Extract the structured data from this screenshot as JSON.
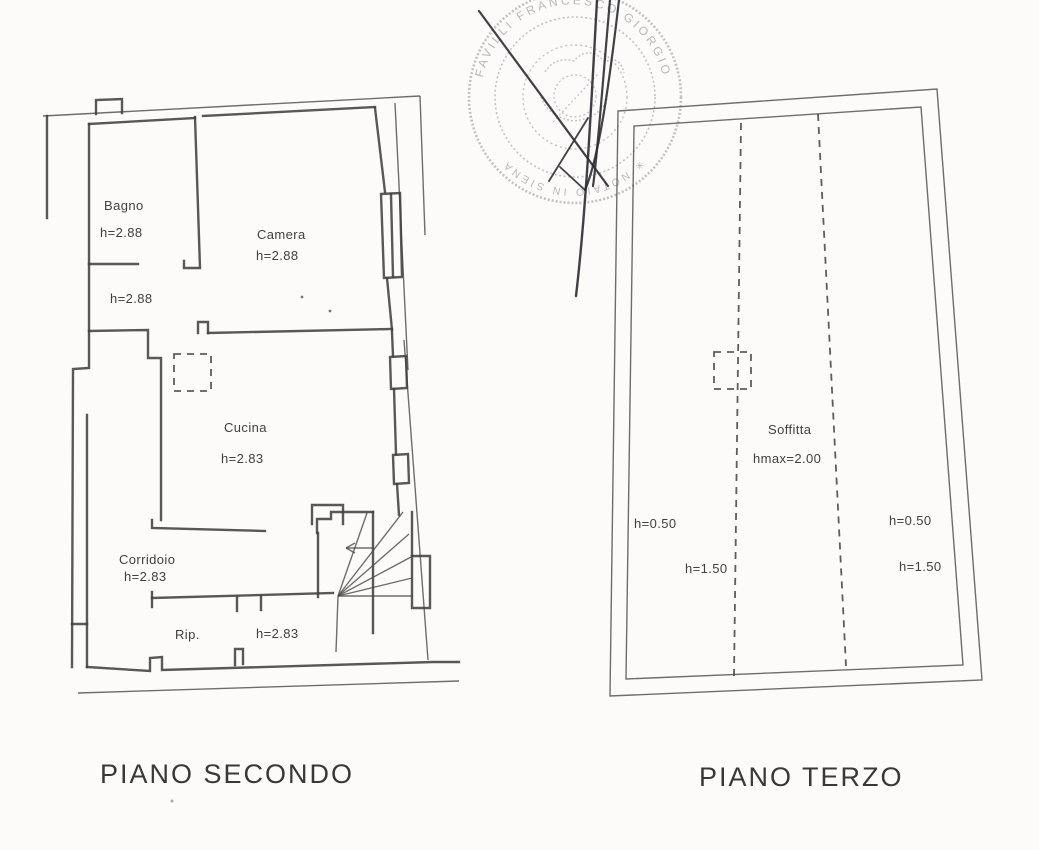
{
  "document": {
    "type_note": "scanned cadastral floor plan sheet",
    "background_color": "#fcfbf9",
    "line_color": "#414141"
  },
  "stamp": {
    "ring_text_top": "FAVILLI FRANCESCO GIORGIO",
    "ring_text_bottom": "✳ NOTAIO IN SIENA",
    "color": "#b2b4b6"
  },
  "plan_secondo": {
    "title": "PIANO SECONDO",
    "labels": {
      "bagno": "Bagno",
      "bagno_h": "h=2.88",
      "camera": "Camera",
      "camera_h": "h=2.88",
      "disimpegno_h": "h=2.88",
      "cucina": "Cucina",
      "cucina_h": "h=2.83",
      "corridoio": "Corridoio",
      "corridoio_h": "h=2.83",
      "rip": "Rip.",
      "rip_h": "h=2.83"
    }
  },
  "plan_terzo": {
    "title": "PIANO TERZO",
    "labels": {
      "soffitta": "Soffitta",
      "hmax": "hmax=2.00",
      "h_left_eaves": "h=0.50",
      "h_left_mid": "h=1.50",
      "h_right_eaves": "h=0.50",
      "h_right_mid": "h=1.50"
    }
  }
}
